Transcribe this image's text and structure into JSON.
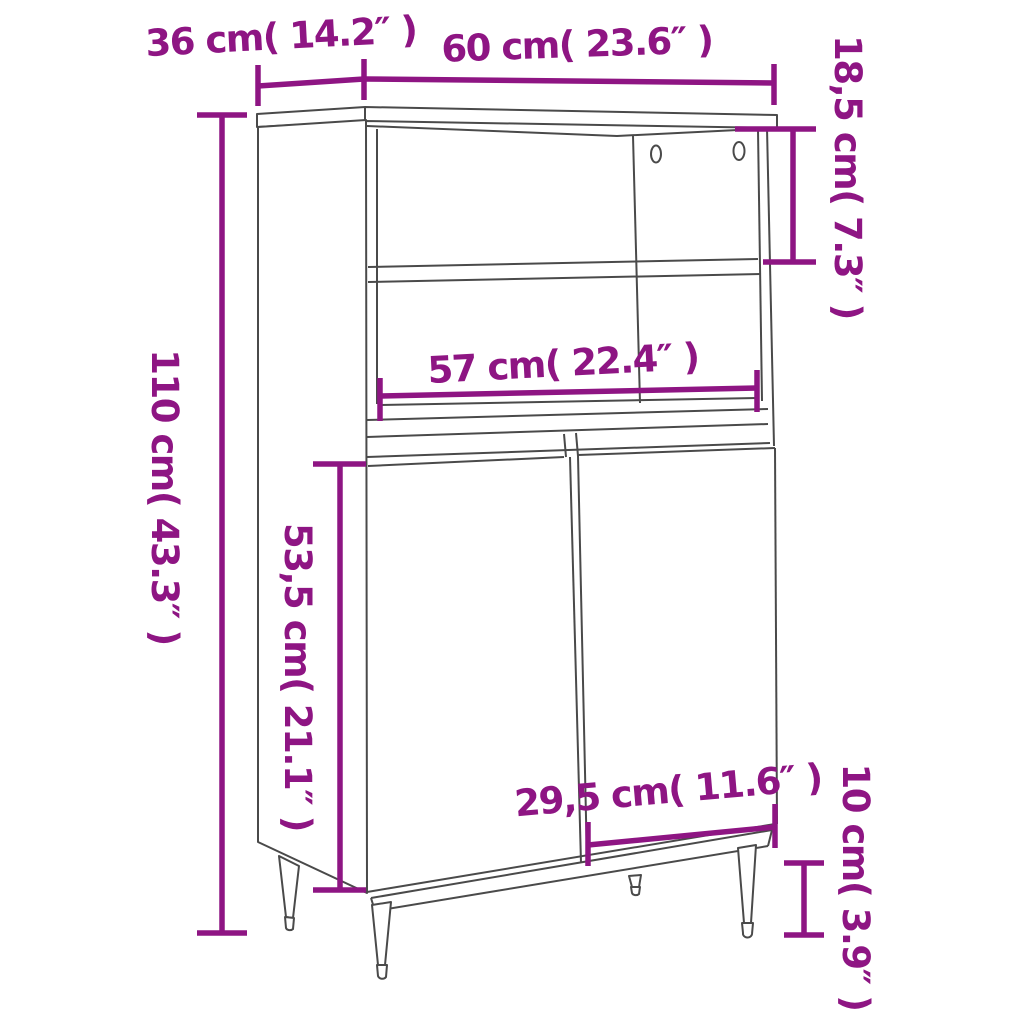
{
  "diagram": {
    "accent_color": "#8E1583",
    "line_color": "#4A4A4A",
    "background_color": "#FFFFFF",
    "dimensions": [
      {
        "name": "depth",
        "label": "36 cm( 14.2″ )"
      },
      {
        "name": "overall-width",
        "label": "60 cm( 23.6″ )"
      },
      {
        "name": "top-compartment-height",
        "label": "18,5 cm( 7.3″ )"
      },
      {
        "name": "overall-height",
        "label": "110 cm( 43.3″ )"
      },
      {
        "name": "inner-width",
        "label": "57 cm( 22.4″ )"
      },
      {
        "name": "door-section-height",
        "label": "53,5 cm( 21.1″ )"
      },
      {
        "name": "door-width",
        "label": "29,5 cm( 11.6″ )"
      },
      {
        "name": "leg-height",
        "label": "10 cm( 3.9″ )"
      }
    ]
  }
}
